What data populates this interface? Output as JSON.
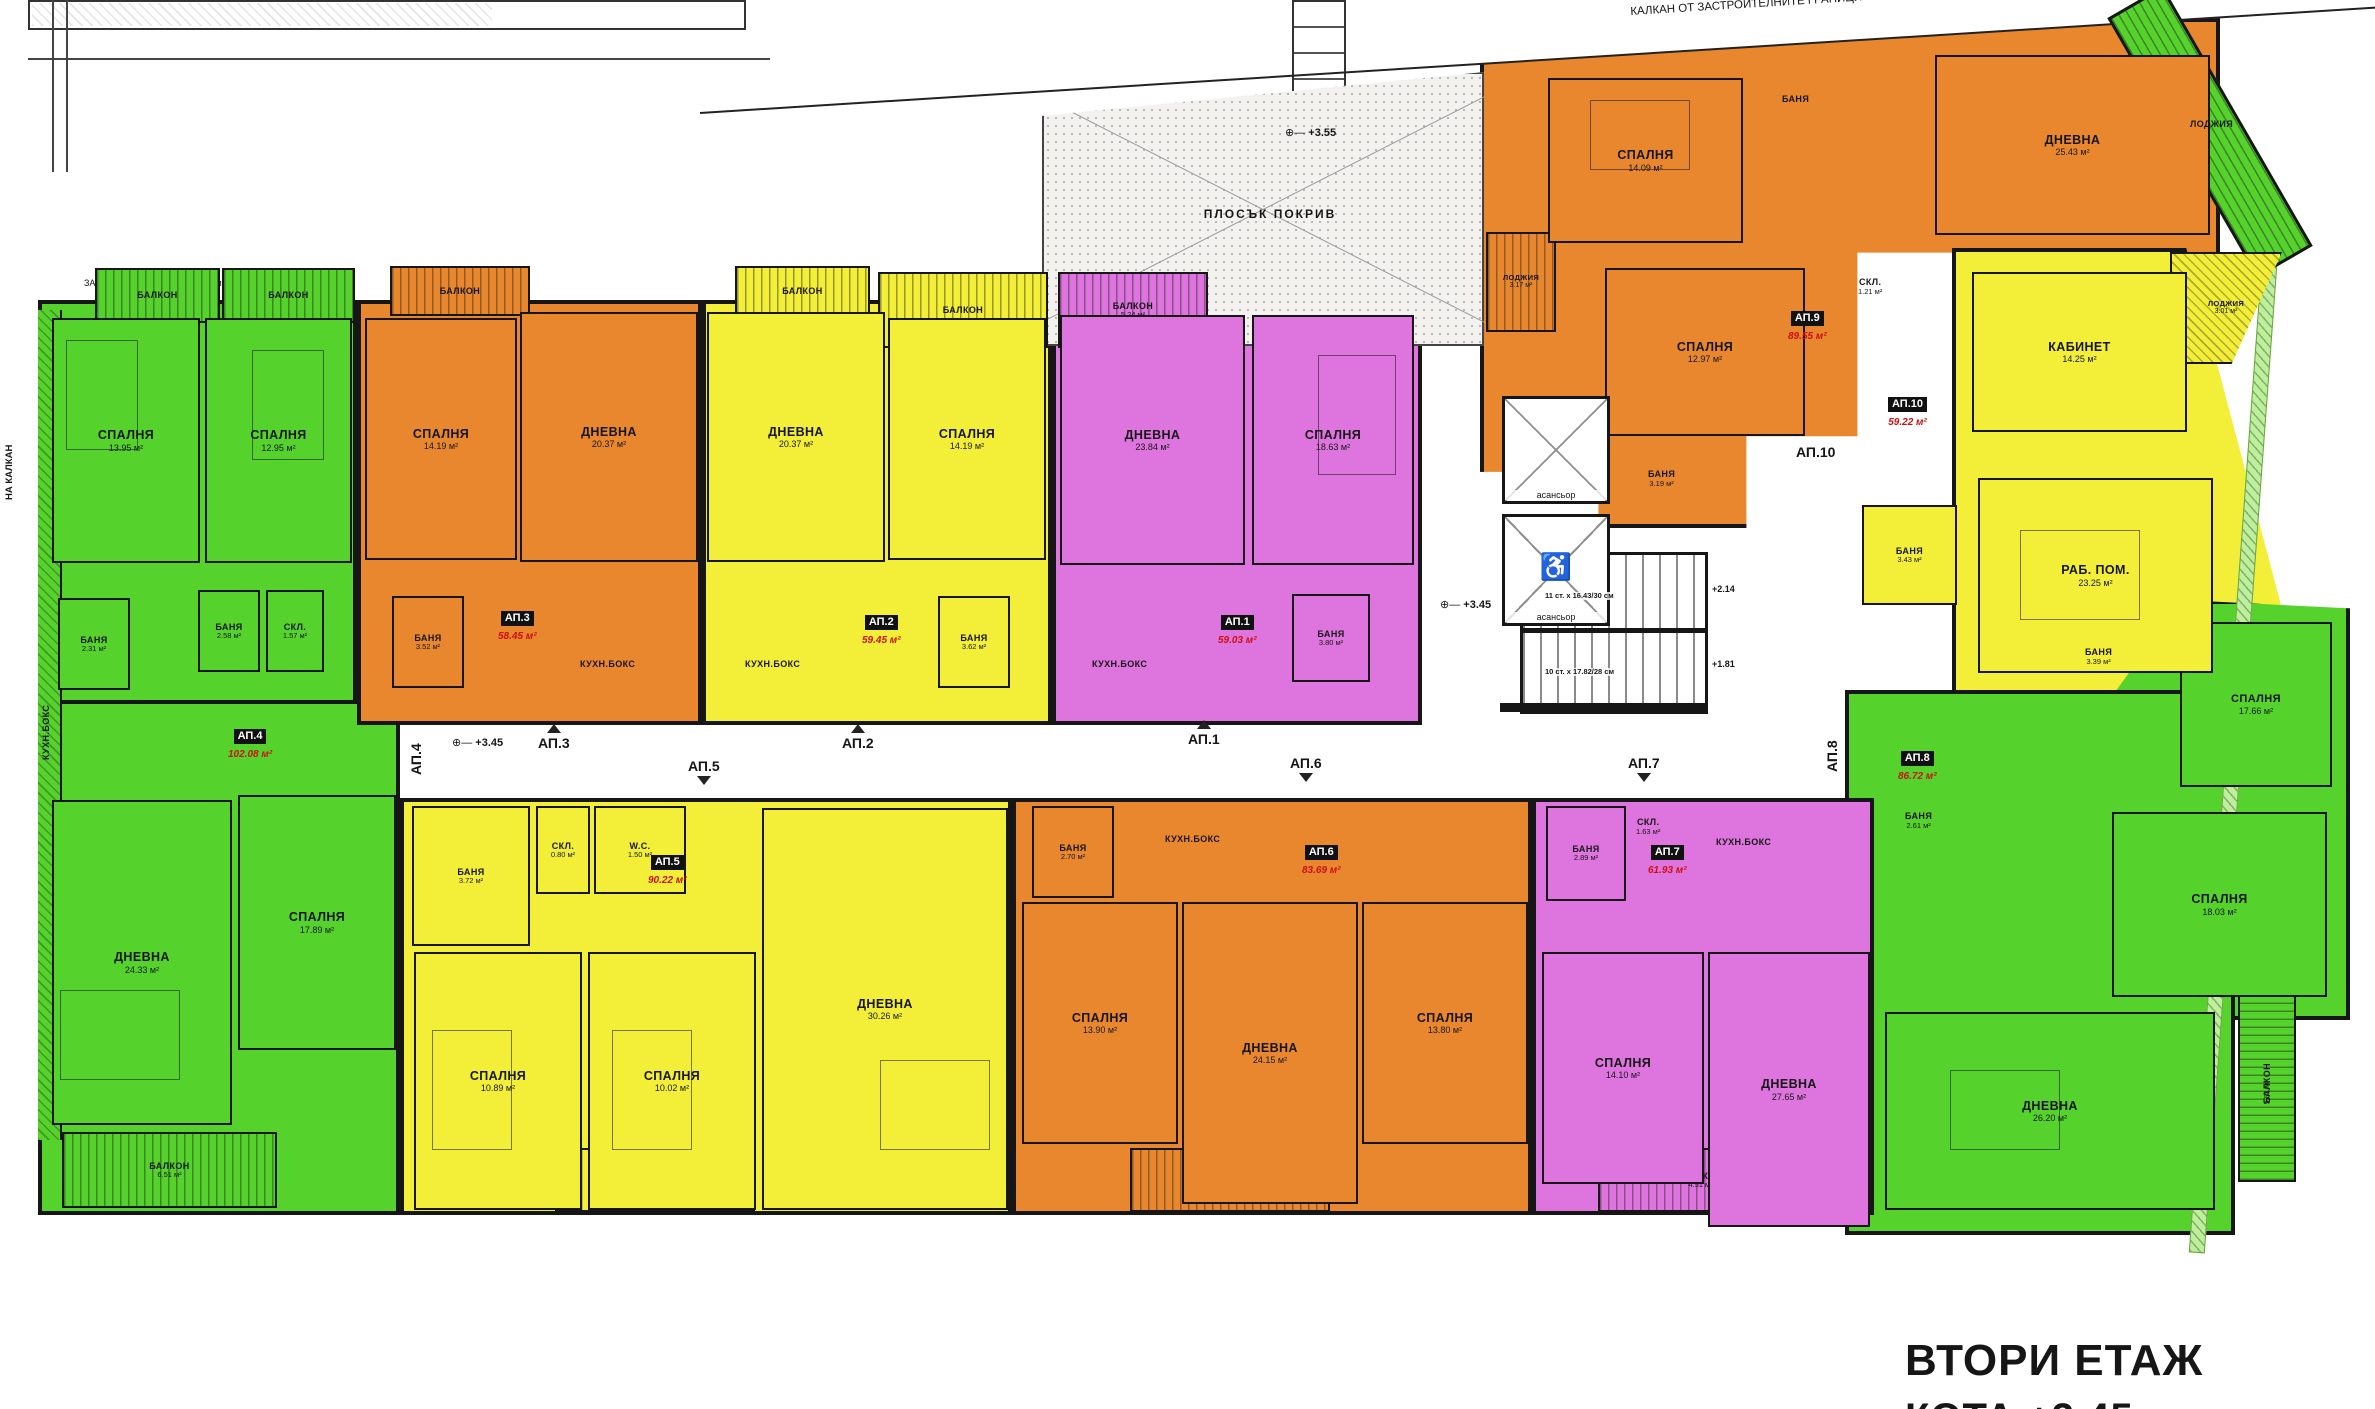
{
  "title": {
    "main": "ВТОРИ ЕТАЖ",
    "sub": "КОТА +3.45"
  },
  "colors": {
    "green": "#55d22c",
    "orange": "#e8872e",
    "yellow": "#f3ef39",
    "magenta": "#de74de",
    "wall": "#161616",
    "area_text": "#cc1111"
  },
  "annotations": {
    "kalkan_top": "КАЛКАН ОТ ЗАСТРОИТЕЛНИТЕ ГРАНИЦИ",
    "boundary_left": "ЗАСТРОИТЕЛНА ГРАНИЦА: 15м",
    "kalkan_left": "НА КАЛКАН",
    "flat_roof": "ПЛОСЪК ПОКРИВ",
    "roof_level": "+3.55",
    "level_345": "+3.45",
    "stair_level_upper": "+2.14",
    "stair_level_lower": "+1.81",
    "stair_note_1": "11 ст. х 16.43/30 см",
    "stair_note_2": "10 ст. х 17.82/28 см",
    "elevator": "асансьор",
    "loggia": "ЛОДЖИЯ"
  },
  "apartments": [
    {
      "id": "АП.1",
      "area": "59.03 м²",
      "rooms": [
        {
          "name": "ДНЕВНА",
          "area": "23.84 м²"
        },
        {
          "name": "СПАЛНЯ",
          "area": "18.63 м²"
        },
        {
          "name": "БАНЯ",
          "area": "3.80 м²"
        },
        {
          "name": "КУХН.БОКС",
          "area": ""
        },
        {
          "name": "БАЛКОН",
          "area": "5.24 м²"
        }
      ]
    },
    {
      "id": "АП.2",
      "area": "59.45 м²",
      "rooms": [
        {
          "name": "ДНЕВНА",
          "area": "20.37 м²"
        },
        {
          "name": "СПАЛНЯ",
          "area": "14.19 м²"
        },
        {
          "name": "БАНЯ",
          "area": "3.62 м²"
        },
        {
          "name": "КУХН.БОКС",
          "area": ""
        },
        {
          "name": "БАЛКОН",
          "area": ""
        },
        {
          "name": "БАЛКОН",
          "area": ""
        }
      ]
    },
    {
      "id": "АП.3",
      "area": "58.45 м²",
      "rooms": [
        {
          "name": "ДНЕВНА",
          "area": "20.37 м²"
        },
        {
          "name": "СПАЛНЯ",
          "area": "14.19 м²"
        },
        {
          "name": "БАНЯ",
          "area": "3.52 м²"
        },
        {
          "name": "КУХН.БОКС",
          "area": ""
        },
        {
          "name": "БАЛКОН",
          "area": ""
        }
      ]
    },
    {
      "id": "АП.4",
      "area": "102.08 м²",
      "rooms": [
        {
          "name": "СПАЛНЯ",
          "area": "13.95 м²"
        },
        {
          "name": "СПАЛНЯ",
          "area": "12.95 м²"
        },
        {
          "name": "ДНЕВНА",
          "area": "24.33 м²"
        },
        {
          "name": "СПАЛНЯ",
          "area": "17.89 м²"
        },
        {
          "name": "БАНЯ",
          "area": "2.31 м²"
        },
        {
          "name": "БАНЯ",
          "area": "2.58 м²"
        },
        {
          "name": "СКЛ.",
          "area": "1.57 м²"
        },
        {
          "name": "БАЛКОН",
          "area": ""
        },
        {
          "name": "БАЛКОН",
          "area": ""
        },
        {
          "name": "БАЛКОН",
          "area": "6.51 м²"
        },
        {
          "name": "КУХН.БОКС",
          "area": ""
        }
      ]
    },
    {
      "id": "АП.5",
      "area": "90.22 м²",
      "rooms": [
        {
          "name": "ДНЕВНА",
          "area": "30.26 м²"
        },
        {
          "name": "СПАЛНЯ",
          "area": "10.89 м²"
        },
        {
          "name": "СПАЛНЯ",
          "area": "10.02 м²"
        },
        {
          "name": "БАНЯ",
          "area": "3.72 м²"
        },
        {
          "name": "СКЛ.",
          "area": "0.80 м²"
        },
        {
          "name": "W.C.",
          "area": "1.50 м²"
        },
        {
          "name": "ЛОДЖИЯ",
          "area": "4.28 м²"
        }
      ]
    },
    {
      "id": "АП.6",
      "area": "83.69 м²",
      "rooms": [
        {
          "name": "ДНЕВНА",
          "area": "24.15 м²"
        },
        {
          "name": "СПАЛНЯ",
          "area": "13.90 м²"
        },
        {
          "name": "СПАЛНЯ",
          "area": "13.80 м²"
        },
        {
          "name": "БАНЯ",
          "area": "2.70 м²"
        },
        {
          "name": "КУХН.БОКС",
          "area": ""
        },
        {
          "name": "ЛОДЖИЯ",
          "area": "4.39 м²"
        }
      ]
    },
    {
      "id": "АП.7",
      "area": "61.93 м²",
      "rooms": [
        {
          "name": "ДНЕВНА",
          "area": "27.65 м²"
        },
        {
          "name": "СПАЛНЯ",
          "area": "14.10 м²"
        },
        {
          "name": "БАНЯ",
          "area": "2.89 м²"
        },
        {
          "name": "СКЛ.",
          "area": "1.63 м²"
        },
        {
          "name": "КУХН.БОКС",
          "area": ""
        },
        {
          "name": "ЛОДЖИЯ",
          "area": "4.51 м²"
        }
      ]
    },
    {
      "id": "АП.8",
      "area": "86.72 м²",
      "rooms": [
        {
          "name": "СПАЛНЯ",
          "area": "17.66 м²"
        },
        {
          "name": "СПАЛНЯ",
          "area": "18.03 м²"
        },
        {
          "name": "ДНЕВНА",
          "area": "26.20 м²"
        },
        {
          "name": "БАНЯ",
          "area": "3.39 м²"
        },
        {
          "name": "БАНЯ",
          "area": "2.61 м²"
        },
        {
          "name": "БАЛКОН",
          "area": "5.81 м²"
        }
      ]
    },
    {
      "id": "АП.9",
      "area": "89.55 м²",
      "rooms": [
        {
          "name": "СПАЛНЯ",
          "area": "14.09 м²"
        },
        {
          "name": "СПАЛНЯ",
          "area": "12.97 м²"
        },
        {
          "name": "ДНЕВНА",
          "area": "25.43 м²"
        },
        {
          "name": "БАНЯ",
          "area": ""
        },
        {
          "name": "БАНЯ",
          "area": "3.19 м²"
        },
        {
          "name": "СКЛ.",
          "area": "1.21 м²"
        },
        {
          "name": "ЛОДЖИЯ",
          "area": "3.17 м²"
        }
      ]
    },
    {
      "id": "АП.10",
      "area": "59.22 м²",
      "rooms": [
        {
          "name": "КАБИНЕТ",
          "area": "14.25 м²"
        },
        {
          "name": "РАБ. ПОМ.",
          "area": "23.25 м²"
        },
        {
          "name": "БАНЯ",
          "area": "3.43 м²"
        },
        {
          "name": "ЛОДЖИЯ",
          "area": "3.01 м²"
        }
      ]
    }
  ]
}
